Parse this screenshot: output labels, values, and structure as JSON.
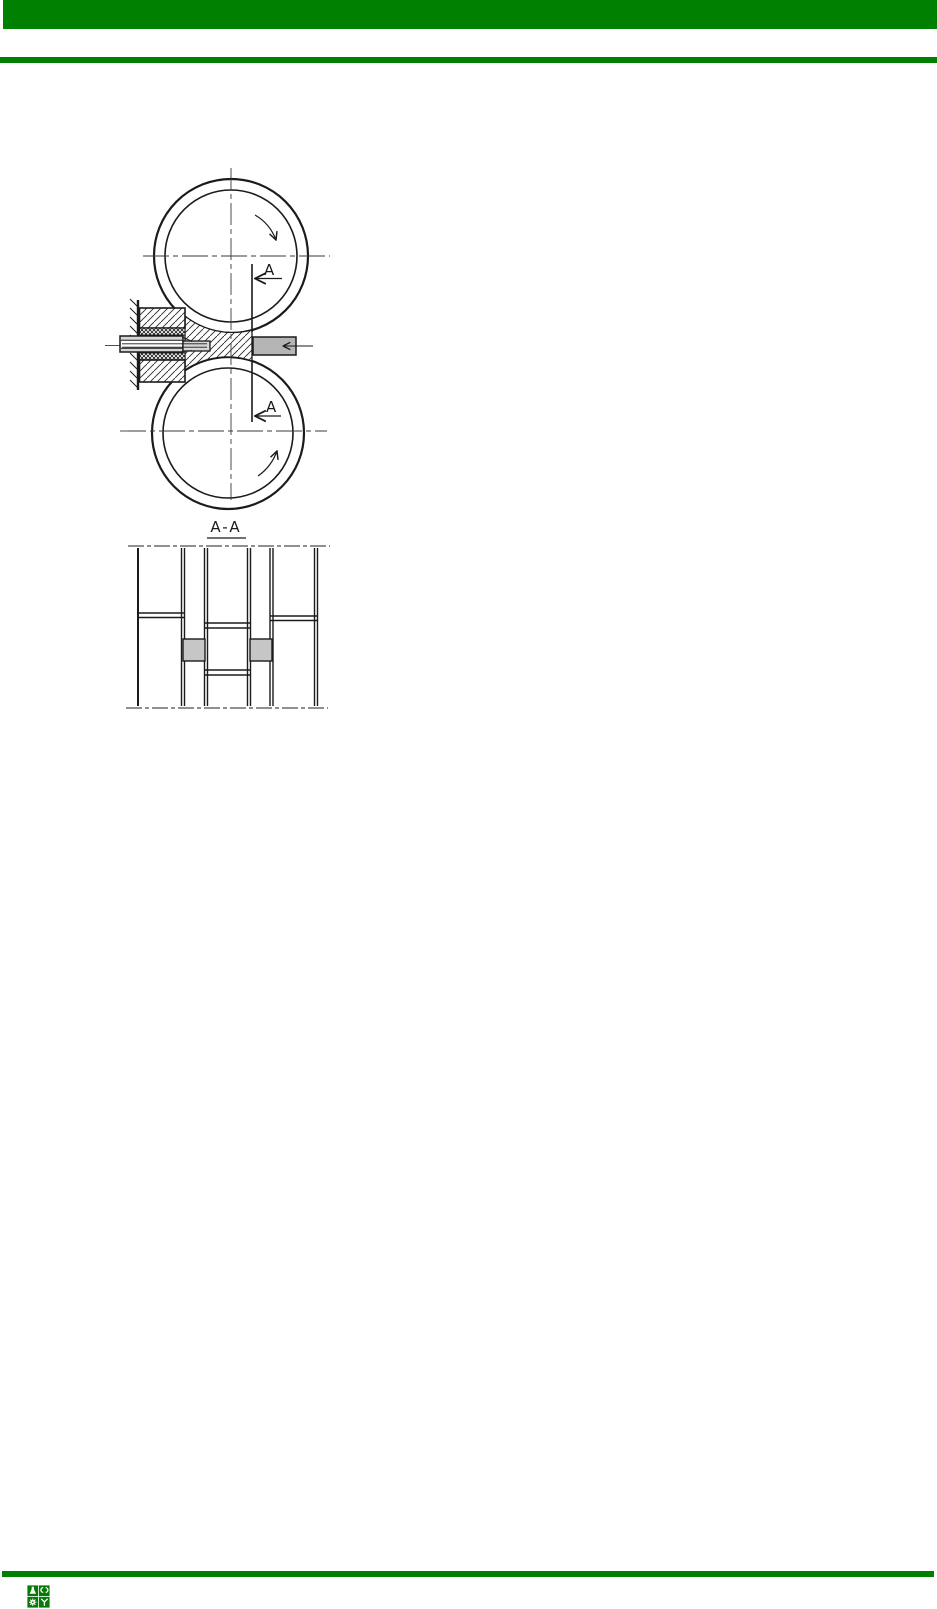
{
  "page": {
    "background": "#ffffff",
    "width_px": 937,
    "height_px": 1609,
    "accent_color": "#008000"
  },
  "header": {
    "bar_color": "#008000",
    "rule_color": "#008000"
  },
  "figure": {
    "description": "Hand-drawn technical diagram: two counter-rotating rolls drawing a workpiece through a die (side view) with section view A-A below",
    "section_marker_top": "A",
    "section_marker_bottom": "A",
    "section_view_title": "A-A",
    "line_color": "#1b1b1b",
    "centerline_color": "#3a3a3a",
    "product_fill": "#b5b5b5",
    "tube_fill": "#d6d6d6",
    "section_square_fill": "#c6c6c6"
  },
  "footer": {
    "rule_color": "#008000",
    "logo_color": "#067a06",
    "logo_tiles": [
      "flask-icon",
      "double-hook-icon",
      "gear-icon",
      "y-fork-icon"
    ]
  }
}
